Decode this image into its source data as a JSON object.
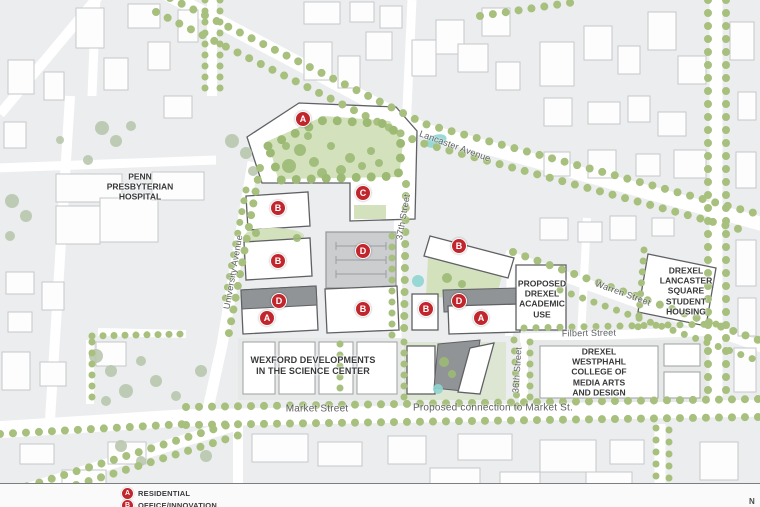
{
  "colors": {
    "bg": "#ebedee",
    "road": "#ffffff",
    "tree_green": "#a7c07d",
    "canopy_green": "#9cba74",
    "muted_tree": "#b9c6ad",
    "park_green": "#d3e2bd",
    "water_teal": "#8ed5d1",
    "marker_red": "#c2262d",
    "focus_stroke": "#5f6164",
    "context_stroke": "#c5c8ca",
    "gray_building": "#919496",
    "label_dark": "#38393b",
    "street_label_gray": "#5d5f61",
    "footer_bg": "#fafafa"
  },
  "map": {
    "street_labels": [
      {
        "id": "lancaster-avenue",
        "text": "Lancaster Avenue"
      },
      {
        "id": "37th-street",
        "text": "37th Street"
      },
      {
        "id": "university-avenue",
        "text": "University Avenue"
      },
      {
        "id": "warren-street",
        "text": "Warren Street"
      },
      {
        "id": "filbert-street",
        "text": "Filbert Street"
      },
      {
        "id": "36th-street",
        "text": "36th Street"
      },
      {
        "id": "market-street",
        "text": "Market Street"
      },
      {
        "id": "proposed-connection",
        "text": "Proposed connection to Market St."
      }
    ],
    "area_labels": [
      {
        "id": "penn-presbyterian-hospital",
        "text": "PENN\nPRESBYTERIAN\nHOSPITAL"
      },
      {
        "id": "wexford-developments",
        "text": "WEXFORD DEVELOPMENTS\nIN THE SCIENCE CENTER"
      },
      {
        "id": "proposed-drexel-academic",
        "text": "PROPOSED\nDREXEL\nACADEMIC\nUSE"
      },
      {
        "id": "drexel-lancaster-square",
        "text": "DREXEL\nLANCASTER\nSQUARE\nSTUDENT\nHOUSING"
      },
      {
        "id": "drexel-westphahl",
        "text": "DREXEL\nWESTPHAHL\nCOLLEGE OF\nMEDIA ARTS\nAND DESIGN"
      }
    ],
    "markers": [
      {
        "letter": "A",
        "x": 303,
        "y": 119
      },
      {
        "letter": "B",
        "x": 278,
        "y": 208
      },
      {
        "letter": "C",
        "x": 363,
        "y": 193
      },
      {
        "letter": "B",
        "x": 278,
        "y": 261
      },
      {
        "letter": "D",
        "x": 363,
        "y": 251
      },
      {
        "letter": "B",
        "x": 459,
        "y": 246
      },
      {
        "letter": "D",
        "x": 279,
        "y": 301
      },
      {
        "letter": "A",
        "x": 267,
        "y": 318
      },
      {
        "letter": "B",
        "x": 363,
        "y": 309
      },
      {
        "letter": "B",
        "x": 426,
        "y": 309
      },
      {
        "letter": "D",
        "x": 459,
        "y": 301
      },
      {
        "letter": "A",
        "x": 481,
        "y": 318
      }
    ]
  },
  "legend": {
    "items": [
      {
        "letter": "A",
        "label": "RESIDENTIAL"
      },
      {
        "letter": "B",
        "label": "OFFICE/INNOVATION"
      }
    ]
  },
  "compass": {
    "north": "N"
  }
}
